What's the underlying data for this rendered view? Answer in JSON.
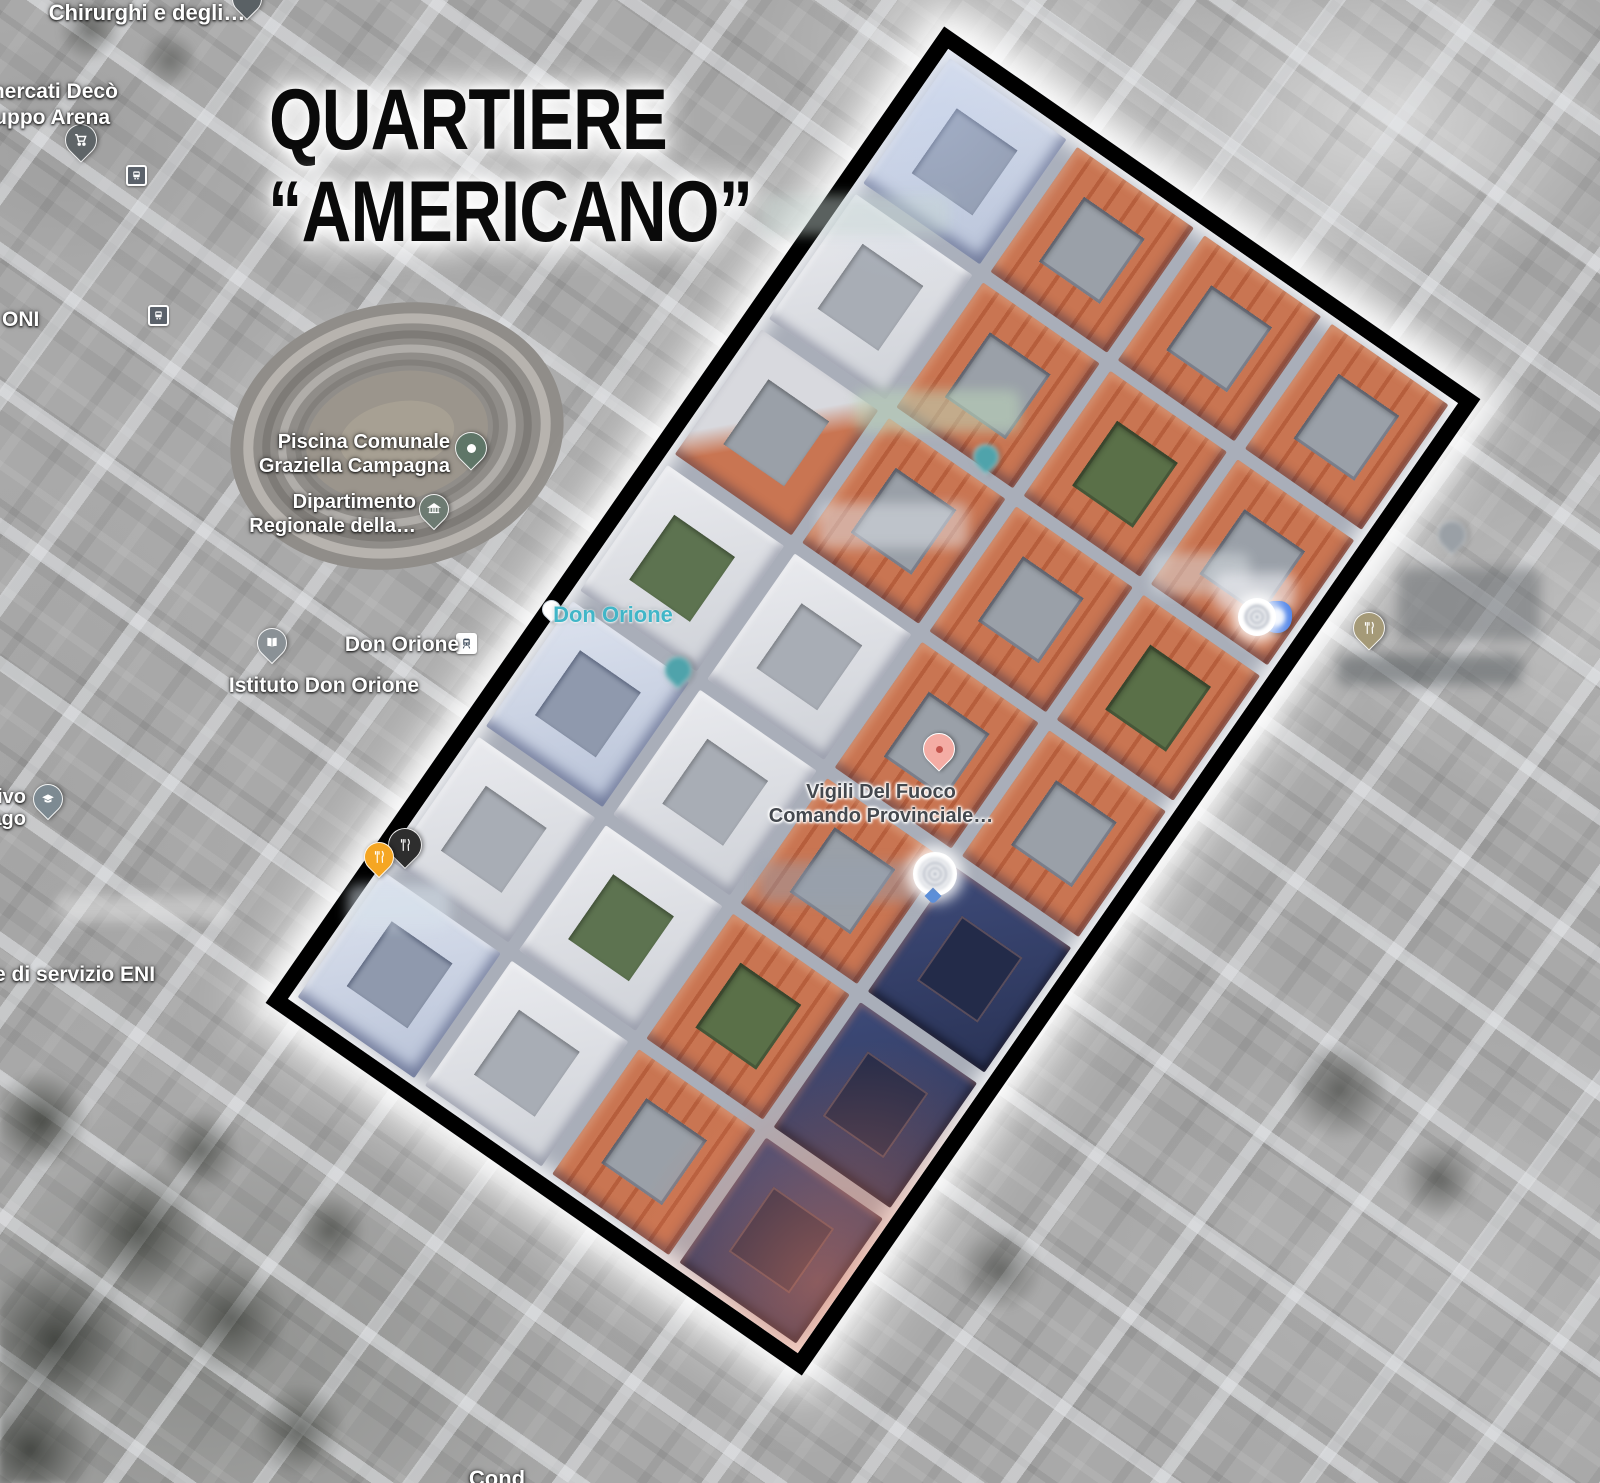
{
  "poster": {
    "title_line1": "QUARTIERE",
    "title_line2": "“AMERICANO”"
  },
  "map_labels": {
    "chirurghi": "Chirurghi e degli…",
    "deco_line1": "mercati Decò",
    "deco_line2": "ruppo Arena",
    "oni": "ONI",
    "piscina_line1": "Piscina Comunale",
    "piscina_line2": "Graziella Campagna",
    "dipartimento_line1": "Dipartimento",
    "dipartimento_line2": "Regionale della…",
    "don_orione_station": "Don Orione",
    "istituto_don_orione": "Istituto Don Orione",
    "don_orione_poi": "Don Orione",
    "vigili_line1": "Vigili Del Fuoco",
    "vigili_line2": "Comando Provinciale…",
    "servizio_eni": "e di servizio ENI",
    "edu_line1": "ivo",
    "edu_line2": "ago",
    "bottom_partial": "Cond"
  },
  "highlight": {
    "shape": "rotated-rectangle",
    "rotation_deg": 34.8,
    "border_color": "#000000",
    "glow_color": "#ffffff",
    "blocks": [
      "bw",
      "o",
      "o",
      "o",
      "w",
      "o",
      "og",
      "o",
      "ow",
      "o",
      "o",
      "og",
      "wg",
      "w",
      "o",
      "o",
      "bw",
      "w",
      "o",
      "nv",
      "w",
      "wg",
      "og",
      "nv",
      "bw",
      "w",
      "o",
      "nv"
    ]
  },
  "palette": {
    "roof_orange": "#c06a45",
    "street_gray": "#a9aeb9",
    "navy_block": "#33406b",
    "cyan_label": "#41b6c8",
    "grayscale_base": "#a9a9a9",
    "pin_orange": "#f5a623",
    "pin_black": "#2e2e2e",
    "pin_tan": "#a59a78",
    "pin_salmon": "#f4aca4",
    "pin_green": "#5f7668",
    "pin_teal": "#4fa3ab",
    "pin_blue": "#4d82e8"
  }
}
